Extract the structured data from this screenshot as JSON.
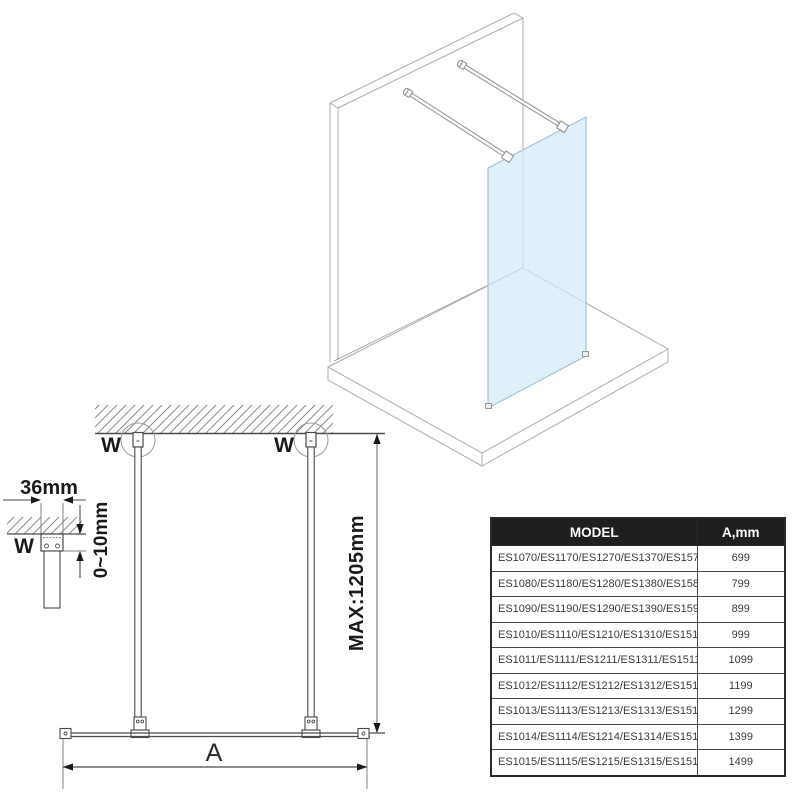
{
  "iso_view": {
    "description": "isometric view of walk-in glass panel with two wall support bars",
    "glass_color": "#d4eaf9",
    "line_color": "#ababab"
  },
  "front_view": {
    "labels": {
      "wall_fixing_left": "W",
      "wall_fixing_right": "W",
      "max_bar_length": "MAX:1205mm",
      "glass_width": "A"
    }
  },
  "mount_detail": {
    "labels": {
      "bracket_width": "36mm",
      "adjustment_range": "0~10mm",
      "wall_fixing": "W"
    }
  },
  "table": {
    "headers": {
      "model": "MODEL",
      "a_mm": "A,mm"
    },
    "rows": [
      {
        "model": "ES1070/ES1170/ES1270/ES1370/ES1570",
        "a": "699"
      },
      {
        "model": "ES1080/ES1180/ES1280/ES1380/ES1580",
        "a": "799"
      },
      {
        "model": "ES1090/ES1190/ES1290/ES1390/ES1590",
        "a": "899"
      },
      {
        "model": "ES1010/ES1110/ES1210/ES1310/ES1510",
        "a": "999"
      },
      {
        "model": "ES1011/ES1111/ES1211/ES1311/ES1511",
        "a": "1099"
      },
      {
        "model": "ES1012/ES1112/ES1212/ES1312/ES1512",
        "a": "1199"
      },
      {
        "model": "ES1013/ES1113/ES1213/ES1313/ES1513",
        "a": "1299"
      },
      {
        "model": "ES1014/ES1114/ES1214/ES1314/ES1514",
        "a": "1399"
      },
      {
        "model": "ES1015/ES1115/ES1215/ES1315/ES1515",
        "a": "1499"
      }
    ],
    "header_bg": "#1f1f1f",
    "header_text_color": "#ffffff"
  }
}
